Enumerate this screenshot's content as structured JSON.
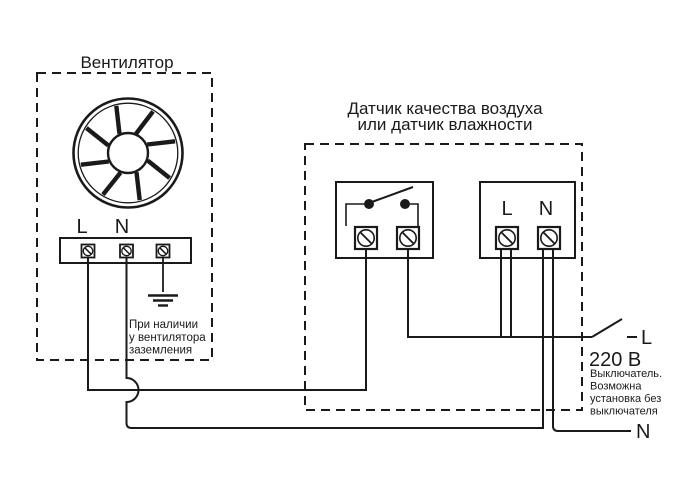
{
  "fan": {
    "title": "Вентилятор",
    "label_l": "L",
    "label_n": "N",
    "ground_note": [
      "При наличии",
      "у вентилятора",
      "заземления"
    ]
  },
  "sensor": {
    "title_line1": "Датчик качества воздуха",
    "title_line2": "или датчик влажности",
    "label_l": "L",
    "label_n": "N"
  },
  "mains": {
    "label_l": "L",
    "label_n": "N",
    "voltage": "220 В",
    "switch_note": [
      "Выключатель.",
      "Возможна",
      "установка без",
      "выключателя"
    ]
  },
  "colors": {
    "ink": "#1a1a1a",
    "background": "#ffffff"
  }
}
